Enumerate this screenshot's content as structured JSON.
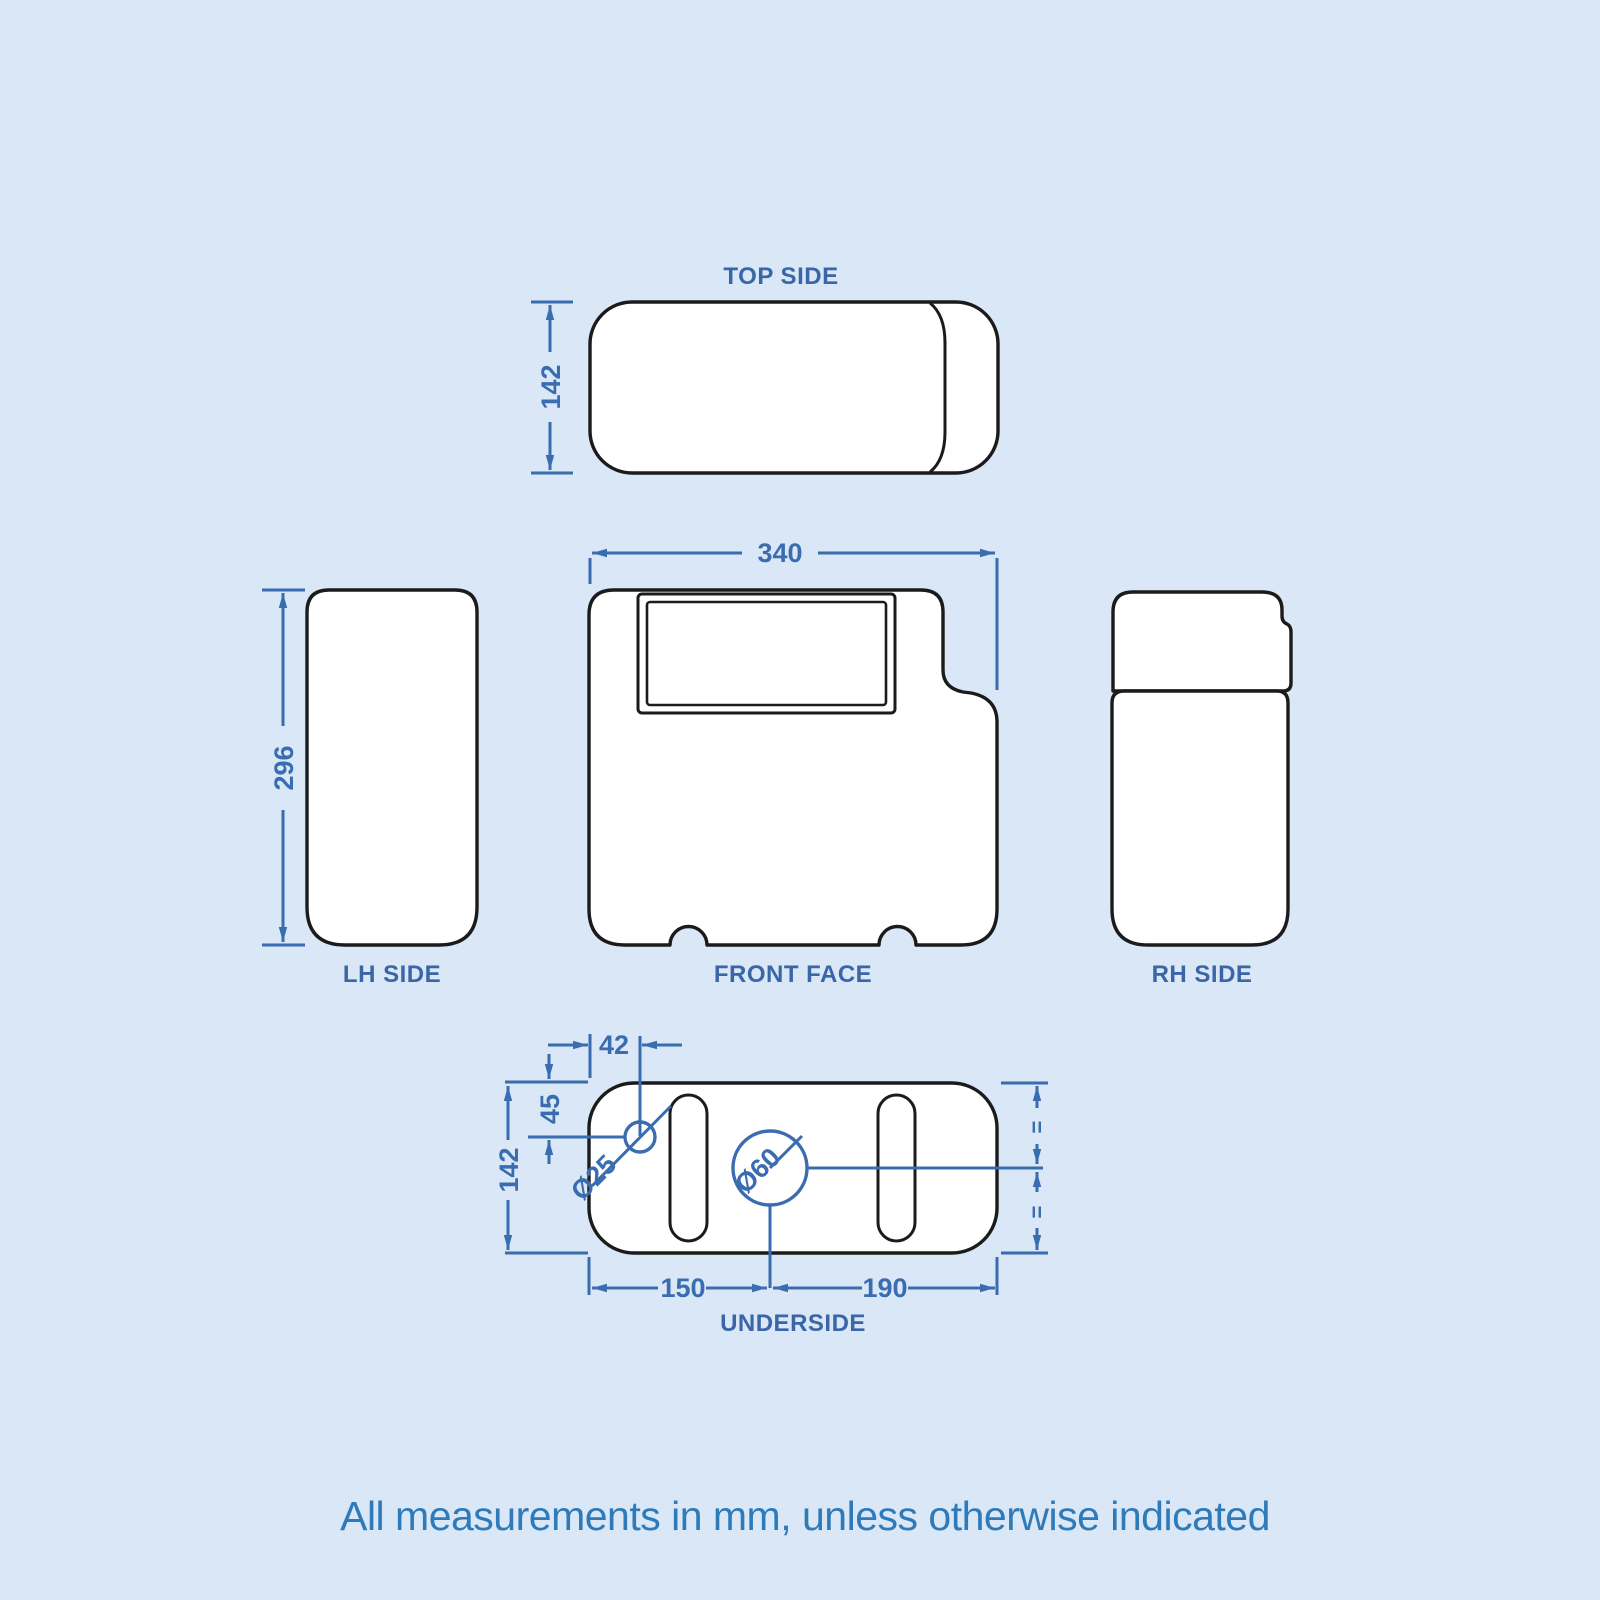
{
  "colors": {
    "background": "#d9e7f7",
    "outline_black": "#1b1b1b",
    "shape_fill": "#ffffff",
    "dimension_blue": "#3a6cb0",
    "label_blue": "#3a66a8",
    "note_blue": "#2f7ab8"
  },
  "views": {
    "top_side": {
      "label": "TOP SIDE",
      "height_dim": "142"
    },
    "lh_side": {
      "label": "LH SIDE",
      "height_dim": "296"
    },
    "front_face": {
      "label": "FRONT FACE",
      "width_dim": "340"
    },
    "rh_side": {
      "label": "RH SIDE"
    },
    "underside": {
      "label": "UNDERSIDE",
      "hole_offset_x_dim": "42",
      "hole_offset_y_dim": "45",
      "depth_dim": "142",
      "left_span_dim": "150",
      "right_span_dim": "190",
      "small_hole_dia": "Ø25",
      "large_hole_dia": "Ø60",
      "equal_mark": "="
    }
  },
  "note": "All measurements in mm, unless otherwise indicated"
}
